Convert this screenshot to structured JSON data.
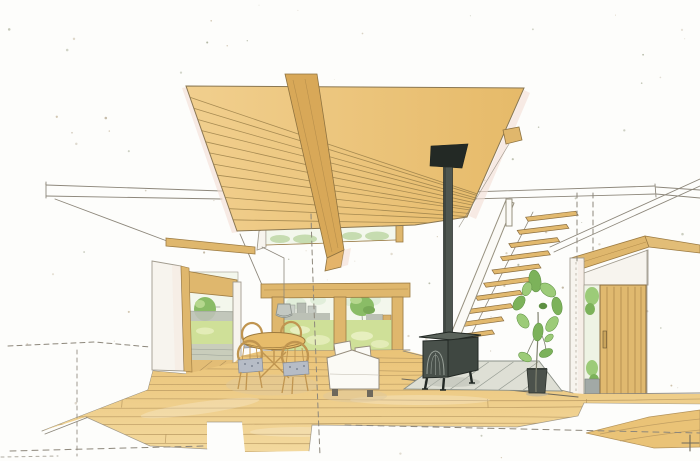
{
  "scene": {
    "title": "Hand-drawn watercolor interior perspective sketch of a living-dining room with wood plank ceiling, wood stove, open-riser stairs and garden views",
    "medium": "pen and watercolor architectural rendering on white paper with construction guide lines",
    "objects": [
      "wood-plank-ceiling",
      "ceiling-beam",
      "loft-beam-end",
      "clerestory-windows",
      "left-loft-ledge",
      "right-loft-ledge",
      "white-sliding-door",
      "left-garden-opening",
      "main-garden-window",
      "garden-lawn",
      "garden-trees",
      "neighbor-deck",
      "pendant-lamp",
      "dining-table",
      "dining-chairs",
      "sofa",
      "wood-stove",
      "stove-chimney",
      "hearth-pad",
      "open-stairs",
      "stair-handrail",
      "potted-plant",
      "entry-door",
      "entry-sidelight",
      "wood-floor",
      "entry-step",
      "construction-dashed-lines",
      "survey-cross-mark",
      "paper-speckles"
    ]
  },
  "colors": {
    "paper": "#fdfdfb",
    "sketch": "#8d877b",
    "outline": "#6f6a5c",
    "ceil_light": "#f1cf8e",
    "ceil_dark": "#e6ba69",
    "plank_line": "#9b8049",
    "beam": "#d8a858",
    "beam_end": "#e4b46a",
    "woodline": "#9c7b42",
    "frame": "#dfb76d",
    "door": "#e0b96f",
    "floor_light": "#f3d99e",
    "floor_mid": "#eac377",
    "floor_line": "#b3935c",
    "lawn": "#cfe098",
    "lawn_light": "#e7efbf",
    "tree": "#8abc66",
    "tree_light": "#b5d78d",
    "tree_dark": "#78a957",
    "glass": "#f3f7ec",
    "sky": "#e1eeda",
    "gray": "#bcc1b6",
    "gray_dark": "#9aa096",
    "paneline": "#a19b8e",
    "panel": "#f7f4ee",
    "pink": "#f4e1d7",
    "stove": "#49514b",
    "stove_side": "#3f4741",
    "stove_top": "#5b635b",
    "stove_dark": "#232925",
    "hearth": "#dedfd5",
    "hearth_line": "#979d94",
    "tread": "#e2b96e",
    "tread_line": "#8a6d3f",
    "sofa": "#fbfaf5",
    "sofa_line": "#958c7c",
    "cushion": "#b6bcc6",
    "cushion_line": "#848b97",
    "chairwood": "#c09550",
    "plant1": "#7cb25a",
    "plant2": "#9ccb78",
    "plant_dark": "#5d8f41",
    "pot": "#4c524c",
    "lamp": "#c3c8c2",
    "lamp_line": "#8e948e",
    "shadow_warm": "#dcc8a0",
    "shadow_gray": "#b6bab0"
  }
}
